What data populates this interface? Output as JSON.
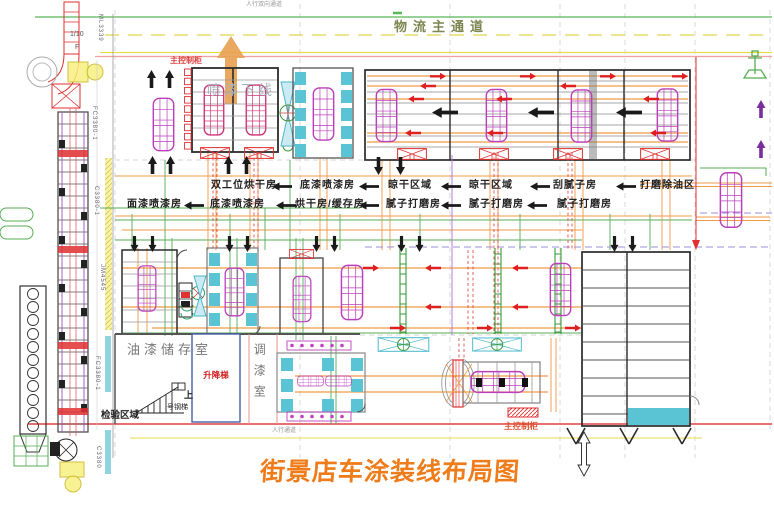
{
  "title": "街景店车涂装线布局图",
  "corridor": {
    "pedestrian_top": "人行双向通道",
    "logistics_main": "物流主通道",
    "pedestrian_bottom": "人行通道"
  },
  "control_cabinet": {
    "top": "主控制柜",
    "bottom": "主控制柜"
  },
  "annotations": {
    "paint_offline": "喷漆下线"
  },
  "flow_row1": [
    "双工位烘干房",
    "底漆喷漆房",
    "晾干区域",
    "晾干区域",
    "刮腻子房",
    "打磨除油区"
  ],
  "flow_row2": [
    "面漆喷漆房",
    "底漆喷漆房",
    "烘干房/缓存房",
    "腻子打磨房",
    "腻子打磨房",
    "腻子打磨房"
  ],
  "rooms": {
    "paint_storage": "油漆储存室",
    "elevator": "升降梯",
    "paint_mixing": "调漆室",
    "inspection_area": "检验区域",
    "stair_up": "上",
    "stair_name": "号钢梯"
  },
  "reference_marks": {
    "scale": "1/10",
    "flag": "F",
    "col_top": "ML3339",
    "col_fc1": "FC3380-1",
    "col_c1": "C3380-1",
    "col_jm": "JM4545",
    "col_fc2": "FC3380-1",
    "col_c2": "C3380"
  },
  "colors": {
    "title_orange": "#EF7C1A",
    "vehicle_magenta": "#BB3FBB",
    "conveyor_orange": "#F09A45",
    "line_green": "#55AE55",
    "alert_red": "#E03030",
    "filter_cyan": "#5BC4D4",
    "corridor_yellow": "#E8DC4A"
  }
}
